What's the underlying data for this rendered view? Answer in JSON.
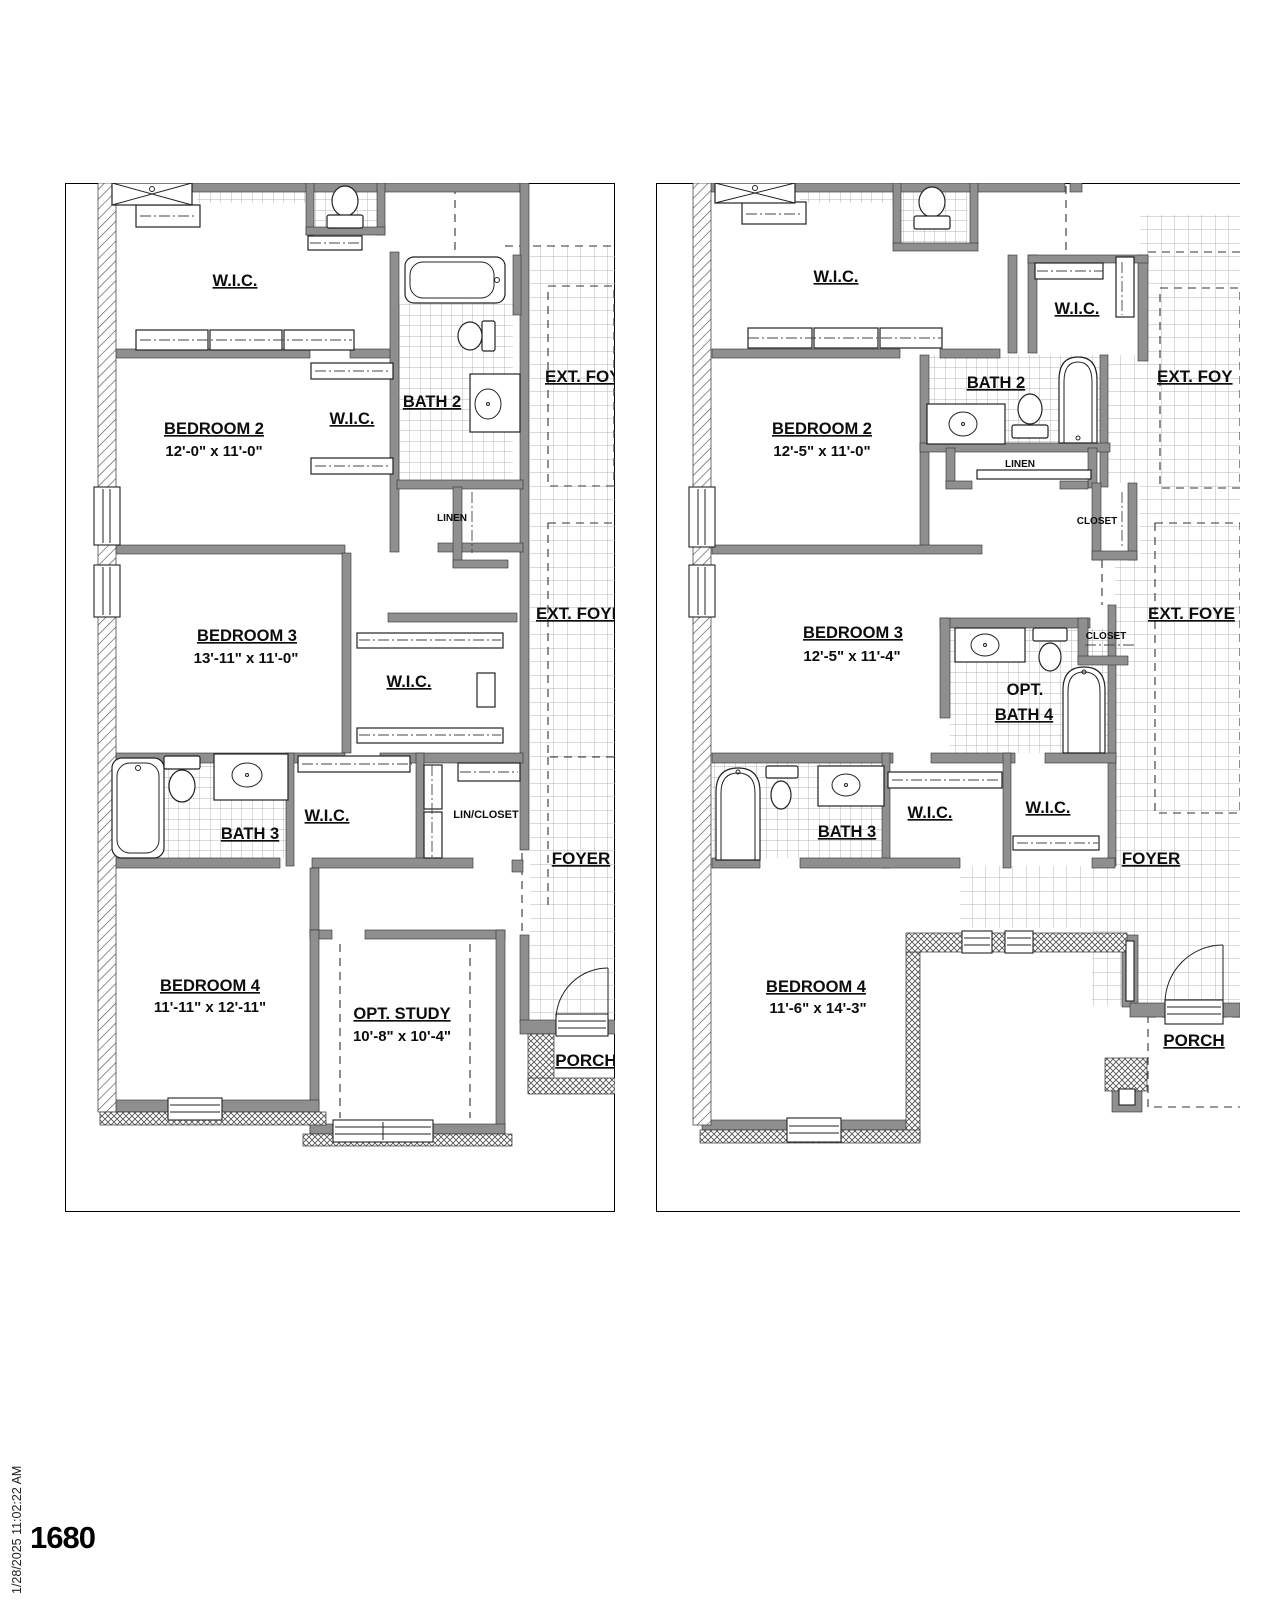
{
  "meta": {
    "sheet_number": "1680",
    "plot_timestamp": "1/28/2025 11:02:22 AM"
  },
  "plan_a": {
    "wic_top": "W.I.C.",
    "wic_bedroom2": "W.I.C.",
    "wic_bedroom3": "W.I.C.",
    "wic_hall": "W.I.C.",
    "bath2": "BATH 2",
    "bath3": "BATH 3",
    "linen": "LINEN",
    "lin_closet": "LIN/CLOSET",
    "ext_foy_upper": "EXT. FOY",
    "ext_foy_lower": "EXT. FOYE",
    "foyer": "FOYER",
    "porch": "PORCH",
    "bedroom2": {
      "name": "BEDROOM 2",
      "dims": "12'-0\" x 11'-0\""
    },
    "bedroom3": {
      "name": "BEDROOM 3",
      "dims": "13'-11\" x 11'-0\""
    },
    "bedroom4": {
      "name": "BEDROOM 4",
      "dims": "11'-11\" x 12'-11\""
    },
    "opt_study": {
      "name": "OPT. STUDY",
      "dims": "10'-8\" x 10'-4\""
    }
  },
  "plan_b": {
    "wic_top": "W.I.C.",
    "wic_upper2": "W.I.C.",
    "wic_hall_left": "W.I.C.",
    "wic_hall_right": "W.I.C.",
    "bath2": "BATH 2",
    "bath3": "BATH 3",
    "linen": "LINEN",
    "closet_upper": "CLOSET",
    "closet_bath4": "CLOSET",
    "opt_bath4_line1": "OPT.",
    "opt_bath4_line2": "BATH 4",
    "ext_foy_upper": "EXT. FOY",
    "ext_foy_lower": "EXT. FOYE",
    "foyer": "FOYER",
    "porch": "PORCH",
    "bedroom2": {
      "name": "BEDROOM 2",
      "dims": "12'-5\" x 11'-0\""
    },
    "bedroom3": {
      "name": "BEDROOM 3",
      "dims": "12'-5\" x 11'-4\""
    },
    "bedroom4": {
      "name": "BEDROOM 4",
      "dims": "11'-6\" x 14'-3\""
    }
  },
  "colors": {
    "wall_gray": "#8f8f8f",
    "line_black": "#0d0d0d",
    "tile_line": "#b5b5b5",
    "hatch_line": "#555555"
  }
}
